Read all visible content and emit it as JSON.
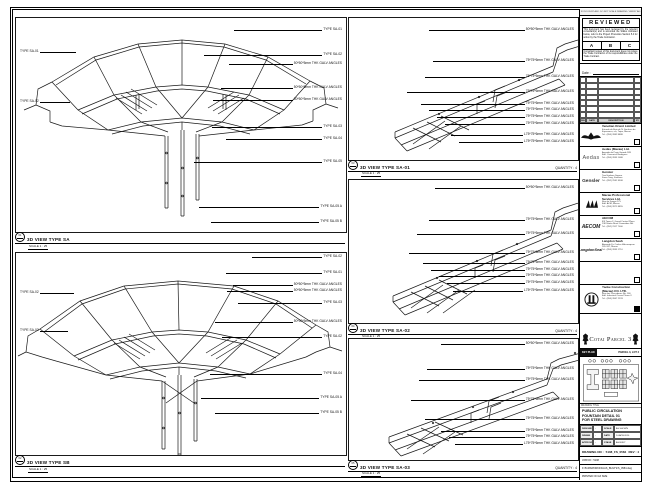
{
  "panels": {
    "top_left": {
      "ref": "01",
      "title": "3D VIEW TYPE SA",
      "scale": "SCALE 1 : 25",
      "labels": [
        {
          "side": "right",
          "y": 10,
          "len": 88,
          "text": "TYPE SA-01"
        },
        {
          "side": "right",
          "y": 35,
          "len": 118,
          "text": "TYPE SA-02"
        },
        {
          "side": "right",
          "y": 44,
          "len": 64,
          "text": "50*50*5mm THK GALV ANGLES"
        },
        {
          "side": "right",
          "y": 68,
          "len": 72,
          "text": "50*50*5mm THK GALV ANGLES"
        },
        {
          "side": "right",
          "y": 80,
          "len": 80,
          "text": "50*50*5mm THK GALV ANGLES"
        },
        {
          "side": "right",
          "y": 107,
          "len": 110,
          "text": "TYPE SA-03"
        },
        {
          "side": "right",
          "y": 119,
          "len": 96,
          "text": "TYPE SA-04"
        },
        {
          "side": "right",
          "y": 142,
          "len": 128,
          "text": "TYPE SA-05"
        },
        {
          "side": "right",
          "y": 187,
          "len": 120,
          "text": "TYPE SA-05 A"
        },
        {
          "side": "right",
          "y": 202,
          "len": 108,
          "text": "TYPE SA-05 B"
        },
        {
          "side": "left",
          "y": 32,
          "len": 36,
          "text": "TYPE SA-01"
        },
        {
          "side": "left",
          "y": 82,
          "len": 30,
          "text": "TYPE SA-02"
        }
      ]
    },
    "bottom_left": {
      "ref": "02",
      "title": "3D VIEW TYPE SB",
      "scale": "SCALE 1 : 25",
      "labels": [
        {
          "side": "right",
          "y": 2,
          "len": 70,
          "text": "TYPE SA-02"
        },
        {
          "side": "right",
          "y": 18,
          "len": 96,
          "text": "TYPE SA-01"
        },
        {
          "side": "right",
          "y": 30,
          "len": 60,
          "text": "50*50*5mm THK GALV ANGLES"
        },
        {
          "side": "right",
          "y": 36,
          "len": 66,
          "text": "50*50*5mm THK GALV ANGLES"
        },
        {
          "side": "right",
          "y": 48,
          "len": 84,
          "text": "TYPE SA-03"
        },
        {
          "side": "right",
          "y": 67,
          "len": 78,
          "text": "50*50*5mm THK GALV ANGLES"
        },
        {
          "side": "right",
          "y": 82,
          "len": 100,
          "text": "TYPE SA-02"
        },
        {
          "side": "right",
          "y": 119,
          "len": 112,
          "text": "TYPE SA-04"
        },
        {
          "side": "right",
          "y": 143,
          "len": 118,
          "text": "TYPE SA-05 A"
        },
        {
          "side": "right",
          "y": 158,
          "len": 104,
          "text": "TYPE SA-05 B"
        },
        {
          "side": "left",
          "y": 38,
          "len": 34,
          "text": "TYPE SA-02"
        },
        {
          "side": "left",
          "y": 76,
          "len": 28,
          "text": "TYPE SA-03"
        }
      ]
    },
    "mid_1": {
      "ref": "03",
      "title": "3D VIEW TYPE SA-01",
      "scale": "SCALE 1 : 25",
      "qty": "QUANTITY : 4",
      "labels": [
        {
          "side": "right",
          "y": 10,
          "len": 96,
          "text": "50*50*5mm THK GALV ANGLES"
        },
        {
          "side": "right",
          "y": 41,
          "len": 92,
          "text": "75*75*6mm THK GALV ANGLES"
        },
        {
          "side": "right",
          "y": 57,
          "len": 100,
          "text": "75*75*6mm THK GALV ANGLES"
        },
        {
          "side": "right",
          "y": 72,
          "len": 118,
          "text": "75*75*6mm THK GALV ANGLES"
        },
        {
          "side": "right",
          "y": 84,
          "len": 104,
          "text": "75*75*6mm THK GALV ANGLES"
        },
        {
          "side": "right",
          "y": 90,
          "len": 96,
          "text": "75*75*6mm THK GALV ANGLES"
        },
        {
          "side": "right",
          "y": 97,
          "len": 88,
          "text": "75*75*6mm THK GALV ANGLES"
        },
        {
          "side": "right",
          "y": 104,
          "len": 80,
          "text": "75*75*6mm THK GALV ANGLES"
        },
        {
          "side": "right",
          "y": 115,
          "len": 72,
          "text": "L75*75*6mm THK GALV ANGLES"
        },
        {
          "side": "right",
          "y": 122,
          "len": 64,
          "text": "L75*75*6mm THK GALV ANGLES"
        }
      ]
    },
    "mid_2": {
      "ref": "04",
      "title": "3D VIEW TYPE SA-02",
      "scale": "SCALE 1 : 25",
      "qty": "QUANTITY : 4",
      "labels": [
        {
          "side": "right",
          "y": 6,
          "len": 90,
          "text": "50*50*5mm THK GALV ANGLES"
        },
        {
          "side": "right",
          "y": 38,
          "len": 96,
          "text": "75*75*6mm THK GALV ANGLES"
        },
        {
          "side": "right",
          "y": 52,
          "len": 108,
          "text": "75*75*6mm THK GALV ANGLES"
        },
        {
          "side": "right",
          "y": 71,
          "len": 116,
          "text": "75*75*6mm THK GALV ANGLES"
        },
        {
          "side": "right",
          "y": 81,
          "len": 102,
          "text": "75*75*6mm THK GALV ANGLES"
        },
        {
          "side": "right",
          "y": 88,
          "len": 94,
          "text": "75*75*6mm THK GALV ANGLES"
        },
        {
          "side": "right",
          "y": 94,
          "len": 86,
          "text": "75*75*6mm THK GALV ANGLES"
        },
        {
          "side": "right",
          "y": 101,
          "len": 78,
          "text": "75*75*6mm THK GALV ANGLES"
        },
        {
          "side": "right",
          "y": 109,
          "len": 70,
          "text": "L75*75*6mm THK GALV ANGLES"
        }
      ]
    },
    "mid_3": {
      "ref": "05",
      "title": "3D VIEW TYPE SA-03",
      "scale": "SCALE 1 : 25",
      "qty": "QUANTITY : 4",
      "labels": [
        {
          "side": "right",
          "y": 3,
          "len": 84,
          "text": "50*50*5mm THK GALV ANGLES"
        },
        {
          "side": "right",
          "y": 28,
          "len": 98,
          "text": "75*75*6mm THK GALV ANGLES"
        },
        {
          "side": "right",
          "y": 39,
          "len": 106,
          "text": "75*75*6mm THK GALV ANGLES"
        },
        {
          "side": "right",
          "y": 59,
          "len": 114,
          "text": "75*75*6mm THK GALV ANGLES"
        },
        {
          "side": "right",
          "y": 78,
          "len": 100,
          "text": "75*75*6mm THK GALV ANGLES"
        },
        {
          "side": "right",
          "y": 90,
          "len": 84,
          "text": "75*75*6mm THK GALV ANGLES"
        },
        {
          "side": "right",
          "y": 96,
          "len": 76,
          "text": "75*75*6mm THK GALV ANGLES"
        },
        {
          "side": "right",
          "y": 103,
          "len": 68,
          "text": "L75*75*6mm THK GALV ANGLES"
        }
      ]
    }
  },
  "stamp": {
    "strip": "IF IN DOUBT ASK. DO NOT SCALE DRAWING. VERIFY ALL DIMENSIONS ON SITE.",
    "title": "REVIEWED",
    "body": "This document has been reviewed by the relevant consultant(s) and is accorded the Status indicated below, refer to the Project Procedure Section 5.4 for action by the Trade Contractor.",
    "grades": [
      "A",
      "B",
      "C"
    ],
    "note": "Consultant review of this document does not relieve the Trade Contractor of its responsibilities under the Trade Contract.",
    "date_label": "Date :"
  },
  "revisions": {
    "headers": [
      "REV",
      "DATE",
      "DESCRIPTION",
      "BY"
    ],
    "empty_rows": 7
  },
  "consultants": [
    {
      "logo": "venetian",
      "name": "Venetian Orient Limited",
      "lines": [
        "Estrada da Baia de N. Senhora da",
        "Esperanca, s/n, Taipa, Macau",
        "Tel : (853) 2882 8888"
      ],
      "checkbox": "empty"
    },
    {
      "logo": "aedas",
      "name": "Aedas (Macau) Ltd.",
      "lines": [
        "Avenida da Praia Grande 599",
        "Edif. Comercial Rodrigues",
        "Tel : (853) 2833 1088"
      ],
      "checkbox": "empty"
    },
    {
      "logo": "gensler",
      "name": "Gensler",
      "lines": [
        "Two Harbour Square",
        "Kwun Tong, Kowloon",
        "Tel : (852) 2591 9308"
      ],
      "checkbox": "empty"
    },
    {
      "logo": "mps",
      "name": "Macau Professional Services Ltd.",
      "lines": [
        "Rua de Xangai 175",
        "Edif. ACM, Macau",
        "Tel : (853) 2871 8855"
      ],
      "checkbox": "empty"
    },
    {
      "logo": "aecom",
      "name": "AECOM",
      "lines": [
        "8/F Tower 2, Grand Central Plaza",
        "138 Shatin Rural Committee Rd.",
        "Tel : (852) 2317 7000"
      ],
      "checkbox": "empty"
    },
    {
      "logo": "langdon",
      "name": "Langdon Seah",
      "lines": [
        "Alameda Dr. Carlos d'Assumpcao",
        "181-187, Macau",
        "Tel : (853) 2833 1710"
      ],
      "checkbox": "empty"
    },
    {
      "logo": "none",
      "name": "",
      "lines": [],
      "checkbox": "empty"
    },
    {
      "logo": "yaoke",
      "name": "Yaoke Construction (Macau) CO. LTD.",
      "lines": [
        "Rua dos Pescadores No. 166",
        "Edif. Industrial Ocean Phase II",
        "Tel : (853) 2847 2233"
      ],
      "checkbox": "filled"
    }
  ],
  "banner": {
    "title": "Cotai Parcel 3"
  },
  "key_plan": {
    "label": "KEY PLAN",
    "parcel": "PARCEL 3, LOT 2"
  },
  "title_block": {
    "drawing_title_label": "DRAWING TITLE",
    "title_lines": [
      "PUBLIC CIRCULATION",
      "FOUNTAIN DETAIL 01",
      "FOR STEEL DRAWING"
    ],
    "fields": [
      {
        "k": "DESIGNED",
        "v": "-",
        "k2": "SCALE",
        "v2": "AS SHOWN"
      },
      {
        "k": "DRAWN",
        "v": "-",
        "k2": "DATE",
        "v2": "14-APR-2010"
      },
      {
        "k": "APPROVED",
        "v": "-",
        "k2": "STAGE",
        "v2": "AS BUILT"
      }
    ],
    "drawing_no_label": "DRAWING NO :",
    "drawing_no": "5108_FS_0584",
    "rev": "REV : 4",
    "job": "JOB NO : 5108",
    "file": "F:\\5108\\WORKING\\AS_BUILT\\FS_0584.dwg",
    "status": "PRINTED ON A3 SIZE"
  }
}
